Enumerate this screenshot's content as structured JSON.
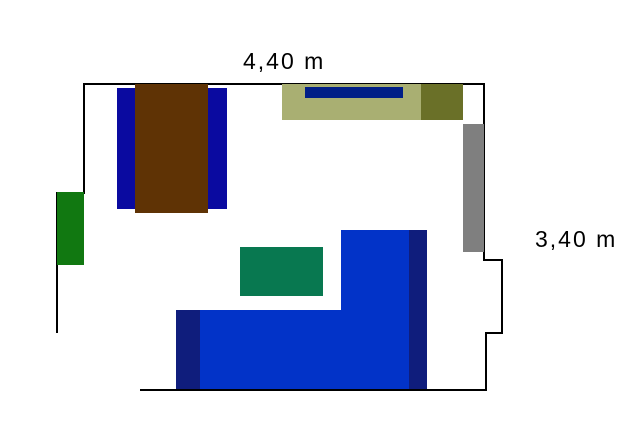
{
  "canvas": {
    "width": 640,
    "height": 432,
    "background": "#ffffff"
  },
  "labels": {
    "top_dimension": {
      "text": "4,40 m"
    },
    "right_dimension": {
      "text": "3,40 m"
    }
  },
  "walls": {
    "color": "#000000",
    "thickness": 2,
    "segments": [
      [
        83,
        84,
        485,
        84
      ],
      [
        84,
        83,
        84,
        194
      ],
      [
        56,
        193,
        84,
        193
      ],
      [
        57,
        193,
        57,
        333
      ],
      [
        484,
        83,
        484,
        261
      ],
      [
        483,
        260,
        502,
        260
      ],
      [
        502,
        259,
        502,
        334
      ],
      [
        502,
        333,
        485,
        333
      ],
      [
        486,
        333,
        486,
        391
      ],
      [
        140,
        390,
        487,
        390
      ]
    ]
  },
  "furniture": [
    {
      "name": "nightstand-left",
      "color": "#0A0AA0",
      "x": 117,
      "y": 88,
      "w": 18,
      "h": 121
    },
    {
      "name": "nightstand-right",
      "color": "#0A0AA0",
      "x": 208,
      "y": 88,
      "w": 19,
      "h": 121
    },
    {
      "name": "bed",
      "color": "#5F3305",
      "x": 135,
      "y": 84,
      "w": 73,
      "h": 129
    },
    {
      "name": "shelf",
      "color": "#A9AF72",
      "x": 282,
      "y": 84,
      "w": 139,
      "h": 36
    },
    {
      "name": "shelf-item",
      "color": "#001E87",
      "x": 305,
      "y": 87,
      "w": 98,
      "h": 11
    },
    {
      "name": "cabinet",
      "color": "#6A7028",
      "x": 421,
      "y": 84,
      "w": 42,
      "h": 36
    },
    {
      "name": "radiator",
      "color": "#7F7F7F",
      "x": 463,
      "y": 124,
      "w": 21,
      "h": 128
    },
    {
      "name": "door",
      "color": "#117811",
      "x": 57,
      "y": 192,
      "w": 27,
      "h": 73
    },
    {
      "name": "table",
      "color": "#087850",
      "x": 240,
      "y": 247,
      "w": 83,
      "h": 49
    },
    {
      "name": "sofa-chaise",
      "color": "#0233C8",
      "x": 176,
      "y": 310,
      "w": 165,
      "h": 79
    },
    {
      "name": "sofa-body",
      "color": "#0233C8",
      "x": 341,
      "y": 230,
      "w": 86,
      "h": 159
    },
    {
      "name": "sofa-armrest-right",
      "color": "#0F1D7C",
      "x": 409,
      "y": 230,
      "w": 18,
      "h": 159
    },
    {
      "name": "sofa-armrest-left",
      "color": "#0F1D7C",
      "x": 176,
      "y": 310,
      "w": 24,
      "h": 79
    }
  ]
}
